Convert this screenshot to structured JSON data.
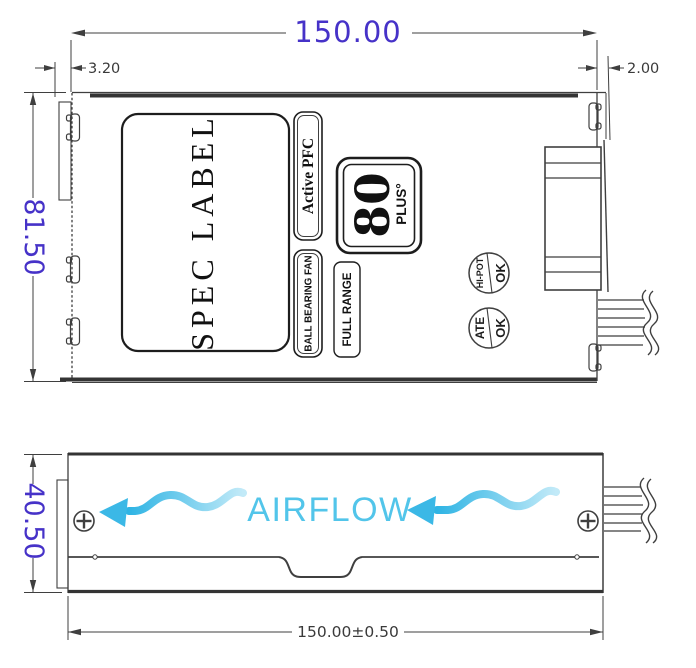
{
  "dimensions": {
    "top_width": "150.00",
    "left_offset": "3.20",
    "right_offset": "2.00",
    "body_depth": "81.50",
    "side_height": "40.50",
    "bottom_width_tolerance": "150.00±0.50"
  },
  "labels": {
    "spec_label": "SPEC LABEL",
    "active_pfc": "Active PFC",
    "ball_bearing_fan": "BALL BEARING FAN",
    "full_range": "FULL RANGE",
    "eighty": "80",
    "plus": "PLUS°",
    "stamp_hipot": "HI-POT",
    "stamp_hipot_ok": "OK",
    "stamp_ate": "ATE",
    "stamp_ate_ok": "OK",
    "airflow": "AIRFLOW"
  },
  "colors": {
    "dimension_accent": "#4632C8",
    "dimension_gray": "#3a3a3a",
    "airflow_text": "#52C5EA",
    "airflow_arrow_head": "#3BB8E6",
    "drawing_line": "#3f3f3f"
  }
}
